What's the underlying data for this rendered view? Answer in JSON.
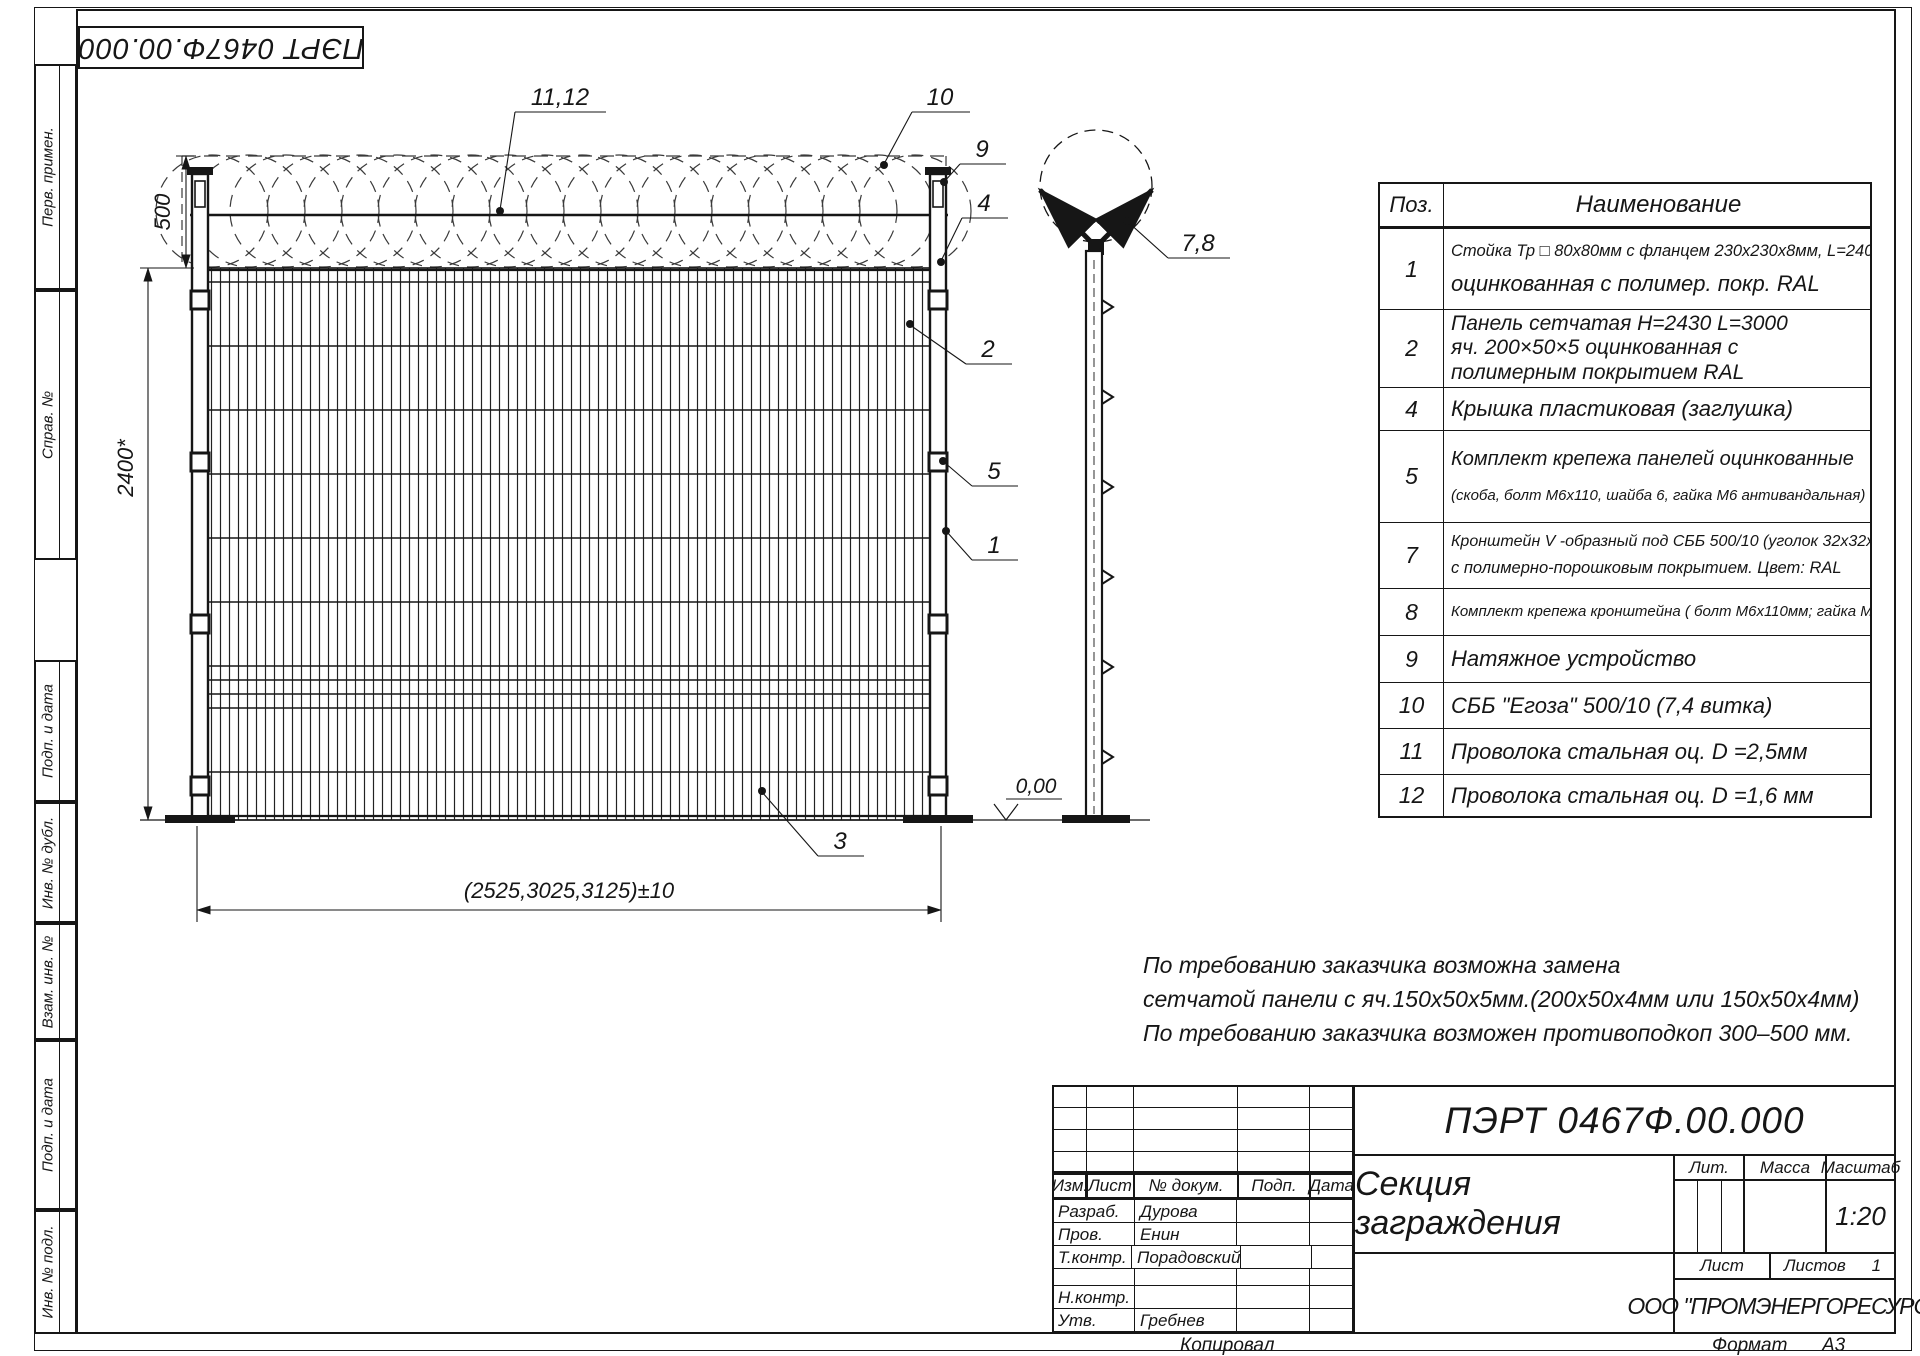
{
  "stamp": {
    "designation": "ПЭРТ 0467Ф.00.000"
  },
  "margin_labels": [
    "Перв. примен.",
    "Справ. №",
    "Подп. и дата",
    "Инв. № дубл.",
    "Взам. инв. №",
    "Подп. и дата",
    "Инв. № подл."
  ],
  "drawing": {
    "dims": {
      "coil_height": "500",
      "fence_height": "2400*",
      "section_width": "(2525,3025,3125)±10",
      "level": "0,00"
    },
    "callouts": {
      "c11_12": "11,12",
      "c10": "10",
      "c9": "9",
      "c4": "4",
      "c2": "2",
      "c5": "5",
      "c1": "1",
      "c3": "3",
      "c7_8": "7,8"
    }
  },
  "parts_table": {
    "headers": {
      "pos": "Поз.",
      "name": "Наименование"
    },
    "rows": [
      {
        "pos": "1",
        "lines": [
          "Стойка Тр □ 80х80мм с фланцем 230х230х8мм, L=2400мм",
          "оцинкованная с полимер. покр. RAL"
        ]
      },
      {
        "pos": "2",
        "lines": [
          "Панель сетчатая  Н=2430  L=3000",
          "яч. 200×50×5 оцинкованная с",
          "полимерным покрытием RAL"
        ]
      },
      {
        "pos": "4",
        "lines": [
          "Крышка пластиковая (заглушка)"
        ]
      },
      {
        "pos": "5",
        "lines": [
          "Комплект крепежа панелей оцинкованные",
          "(скоба, болт М6х110, шайба 6, гайка М6 антивандальная)"
        ]
      },
      {
        "pos": "7",
        "lines": [
          "Кронштейн V -образный под СББ 500/10 (уголок 32х32х4мм)",
          "с полимерно-порошковым покрытием. Цвет: RAL"
        ]
      },
      {
        "pos": "8",
        "lines": [
          "Комплект крепежа кронштейна ( болт М6х110мм;  гайка  М6; шайба 6 )"
        ]
      },
      {
        "pos": "9",
        "lines": [
          "Натяжное устройство"
        ]
      },
      {
        "pos": "10",
        "lines": [
          "СББ \"Егоза\" 500/10 (7,4 витка)"
        ]
      },
      {
        "pos": "11",
        "lines": [
          "Проволока стальная оц. D =2,5мм"
        ]
      },
      {
        "pos": "12",
        "lines": [
          "Проволока стальная оц. D =1,6 мм"
        ]
      }
    ]
  },
  "notes": [
    "По требованию заказчика возможна замена",
    "сетчатой панели с яч.150х50х5мм.(200х50х4мм или 150х50х4мм)",
    "По требованию заказчика возможен противоподкоп 300–500 мм."
  ],
  "title_block": {
    "designation": "ПЭРТ 0467Ф.00.000",
    "title": "Секция заграждения",
    "company": "ООО \"ПРОМЭНЕРГОРЕСУРС \"",
    "scale": "1:20",
    "sheets_value": "1",
    "labels": {
      "izm": "Изм.",
      "list": "Лист",
      "doc": "№ докум.",
      "podp": "Подп.",
      "data": "Дата",
      "lit": "Лит.",
      "massa": "Масса",
      "masshtab": "Масштаб",
      "list2": "Лист",
      "listov": "Листов"
    },
    "sig_rows": [
      {
        "label": "Разраб.",
        "name": "Дурова"
      },
      {
        "label": "Пров.",
        "name": "Енин"
      },
      {
        "label": "Т.контр.",
        "name": "Порадовский"
      },
      {
        "label": "",
        "name": ""
      },
      {
        "label": "Н.контр.",
        "name": ""
      },
      {
        "label": "Утв.",
        "name": "Гребнев"
      }
    ]
  },
  "footer": {
    "copied": "Копировал",
    "format_label": "Формат",
    "format_value": "А3"
  }
}
